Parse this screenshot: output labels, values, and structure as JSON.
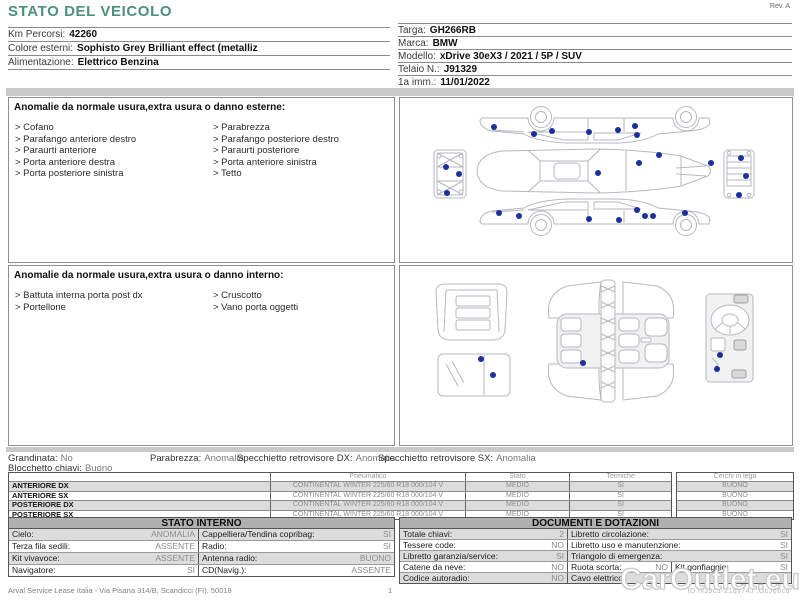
{
  "colors": {
    "accent": "#4e8f7e",
    "marker": "#1d2f9b"
  },
  "page": {
    "rev": "Rev. A",
    "watermark": "CarOutlet.eu",
    "footer_left": "Arval Service Lease Italia - Via Pisana 314/B, Scandicci (FI), 50018",
    "page_number": "1",
    "footer_id": "ID IvJ9c3-21qv74J ,GcJ66cd"
  },
  "header": {
    "title": "STATO DEL VEICOLO",
    "left_fields": [
      {
        "label": "Km Percorsi:",
        "value": "42260"
      },
      {
        "label": "Colore esterni:",
        "value": "Sophisto Grey Brilliant effect (metalliz"
      },
      {
        "label": "Alimentazione:",
        "value": "Elettrico Benzina"
      }
    ],
    "right_fields": [
      {
        "label": "Targa:",
        "value": "GH266RB"
      },
      {
        "label": "Marca:",
        "value": "BMW"
      },
      {
        "label": "Modello:",
        "value": "xDrive 30eX3 / 2021 / 5P / SUV"
      },
      {
        "label": "Telaio N.:",
        "value": "J91329"
      },
      {
        "label": "1a imm.:",
        "value": "11/01/2022"
      }
    ]
  },
  "exterior": {
    "title": "Anomalie da normale usura,extra usura o danno esterne:",
    "items_left": [
      "Cofano",
      "Parafango anteriore destro",
      "Paraurti anteriore",
      "Porta anteriore destra",
      "Porta posteriore sinistra"
    ],
    "items_right": [
      "Parabrezza",
      "Parafango posteriore destro",
      "Paraurti posteriore",
      "Porta anteriore sinistra",
      "Tetto"
    ],
    "markers": [
      [
        94,
        29
      ],
      [
        134,
        36
      ],
      [
        152,
        33
      ],
      [
        189,
        34
      ],
      [
        218,
        32
      ],
      [
        235,
        28
      ],
      [
        237,
        37
      ],
      [
        198,
        75
      ],
      [
        239,
        65
      ],
      [
        259,
        57
      ],
      [
        311,
        65
      ],
      [
        99,
        115
      ],
      [
        119,
        118
      ],
      [
        189,
        121
      ],
      [
        219,
        122
      ],
      [
        237,
        112
      ],
      [
        245,
        118
      ],
      [
        253,
        118
      ],
      [
        285,
        115
      ],
      [
        46,
        69
      ],
      [
        59,
        76
      ],
      [
        47,
        95
      ],
      [
        341,
        60
      ],
      [
        346,
        78
      ],
      [
        339,
        97
      ]
    ]
  },
  "interior": {
    "title": "Anomalie da normale usura,extra usura o danno interno:",
    "items_left": [
      "Battuta interna porta post dx",
      "Portellone"
    ],
    "items_right": [
      "Cruscotto",
      "Vano porta oggetti"
    ],
    "markers": [
      [
        81,
        93
      ],
      [
        93,
        109
      ],
      [
        183,
        97
      ],
      [
        320,
        89
      ],
      [
        317,
        103
      ]
    ]
  },
  "status_line1": [
    {
      "label": "Grandinata:",
      "value": "No"
    },
    {
      "label": "Parabrezza:",
      "value": "Anomalia"
    },
    {
      "label": "Specchietto retrovisore DX:",
      "value": "Anomalia"
    },
    {
      "label": "Specchietto retrovisore SX:",
      "value": "Anomalia"
    }
  ],
  "status_line2": {
    "label": "Blocchetto chiavi:",
    "value": "Buono"
  },
  "tyres": {
    "headers": [
      "Pneumatico",
      "Stato",
      "Termiche",
      "Cerchi in lega"
    ],
    "rows": [
      {
        "position": "ANTERIORE DX",
        "tyre": "CONTINENTAL WINTER 225/60 R18 000/104 V",
        "stato": "MEDIO",
        "termiche": "SI",
        "cerchi": "BUONO"
      },
      {
        "position": "ANTERIORE SX",
        "tyre": "CONTINENTAL WINTER 225/60 R18 000/104 V",
        "stato": "MEDIO",
        "termiche": "SI",
        "cerchi": "BUONO"
      },
      {
        "position": "POSTERIORE DX",
        "tyre": "CONTINENTAL WINTER 225/60 R18 000/104 V",
        "stato": "MEDIO",
        "termiche": "SI",
        "cerchi": "BUONO"
      },
      {
        "position": "POSTERIORE SX",
        "tyre": "CONTINENTAL WINTER 225/60 R18 000/104 V",
        "stato": "MEDIO",
        "termiche": "SI",
        "cerchi": "BUONO"
      }
    ]
  },
  "stato_interno": {
    "title": "STATO INTERNO",
    "rows": [
      [
        {
          "label": "Cielo:",
          "value": "ANOMALIA"
        },
        {
          "label": "Cappelliera/Tendina copribag:",
          "value": "SI"
        }
      ],
      [
        {
          "label": "Terza fila sedili:",
          "value": "ASSENTE"
        },
        {
          "label": "Radio:",
          "value": "SI"
        }
      ],
      [
        {
          "label": "Kit vivavoce:",
          "value": "ASSENTE"
        },
        {
          "label": "Antenna radio:",
          "value": "BUONO"
        }
      ],
      [
        {
          "label": "Navigatore:",
          "value": "SI"
        },
        {
          "label": "CD(Navig.):",
          "value": "ASSENTE"
        }
      ]
    ]
  },
  "documenti": {
    "title": "DOCUMENTI E DOTAZIONI",
    "rows": [
      [
        {
          "label": "Totale chiavi:",
          "value": "2"
        },
        {
          "label": "Libretto circolazione:",
          "value": "SI"
        }
      ],
      [
        {
          "label": "Tessere code:",
          "value": "NO"
        },
        {
          "label": "Libretto uso e manutenzione:",
          "value": "SI"
        }
      ],
      [
        {
          "label": "Libretto garanzia/service:",
          "value": "SI"
        },
        {
          "label": "Triangolo di emergenza:",
          "value": "SI"
        }
      ],
      [
        {
          "label": "Catene da neve:",
          "value": "NO"
        },
        {
          "label": "Ruota scorta:",
          "value": "NO"
        },
        {
          "label": "Kit gonfiaggio:",
          "value": "SI"
        }
      ],
      [
        {
          "label": "Codice autoradio:",
          "value": "NO"
        },
        {
          "label": "Cavo elettrico:",
          "value": ""
        }
      ]
    ]
  }
}
